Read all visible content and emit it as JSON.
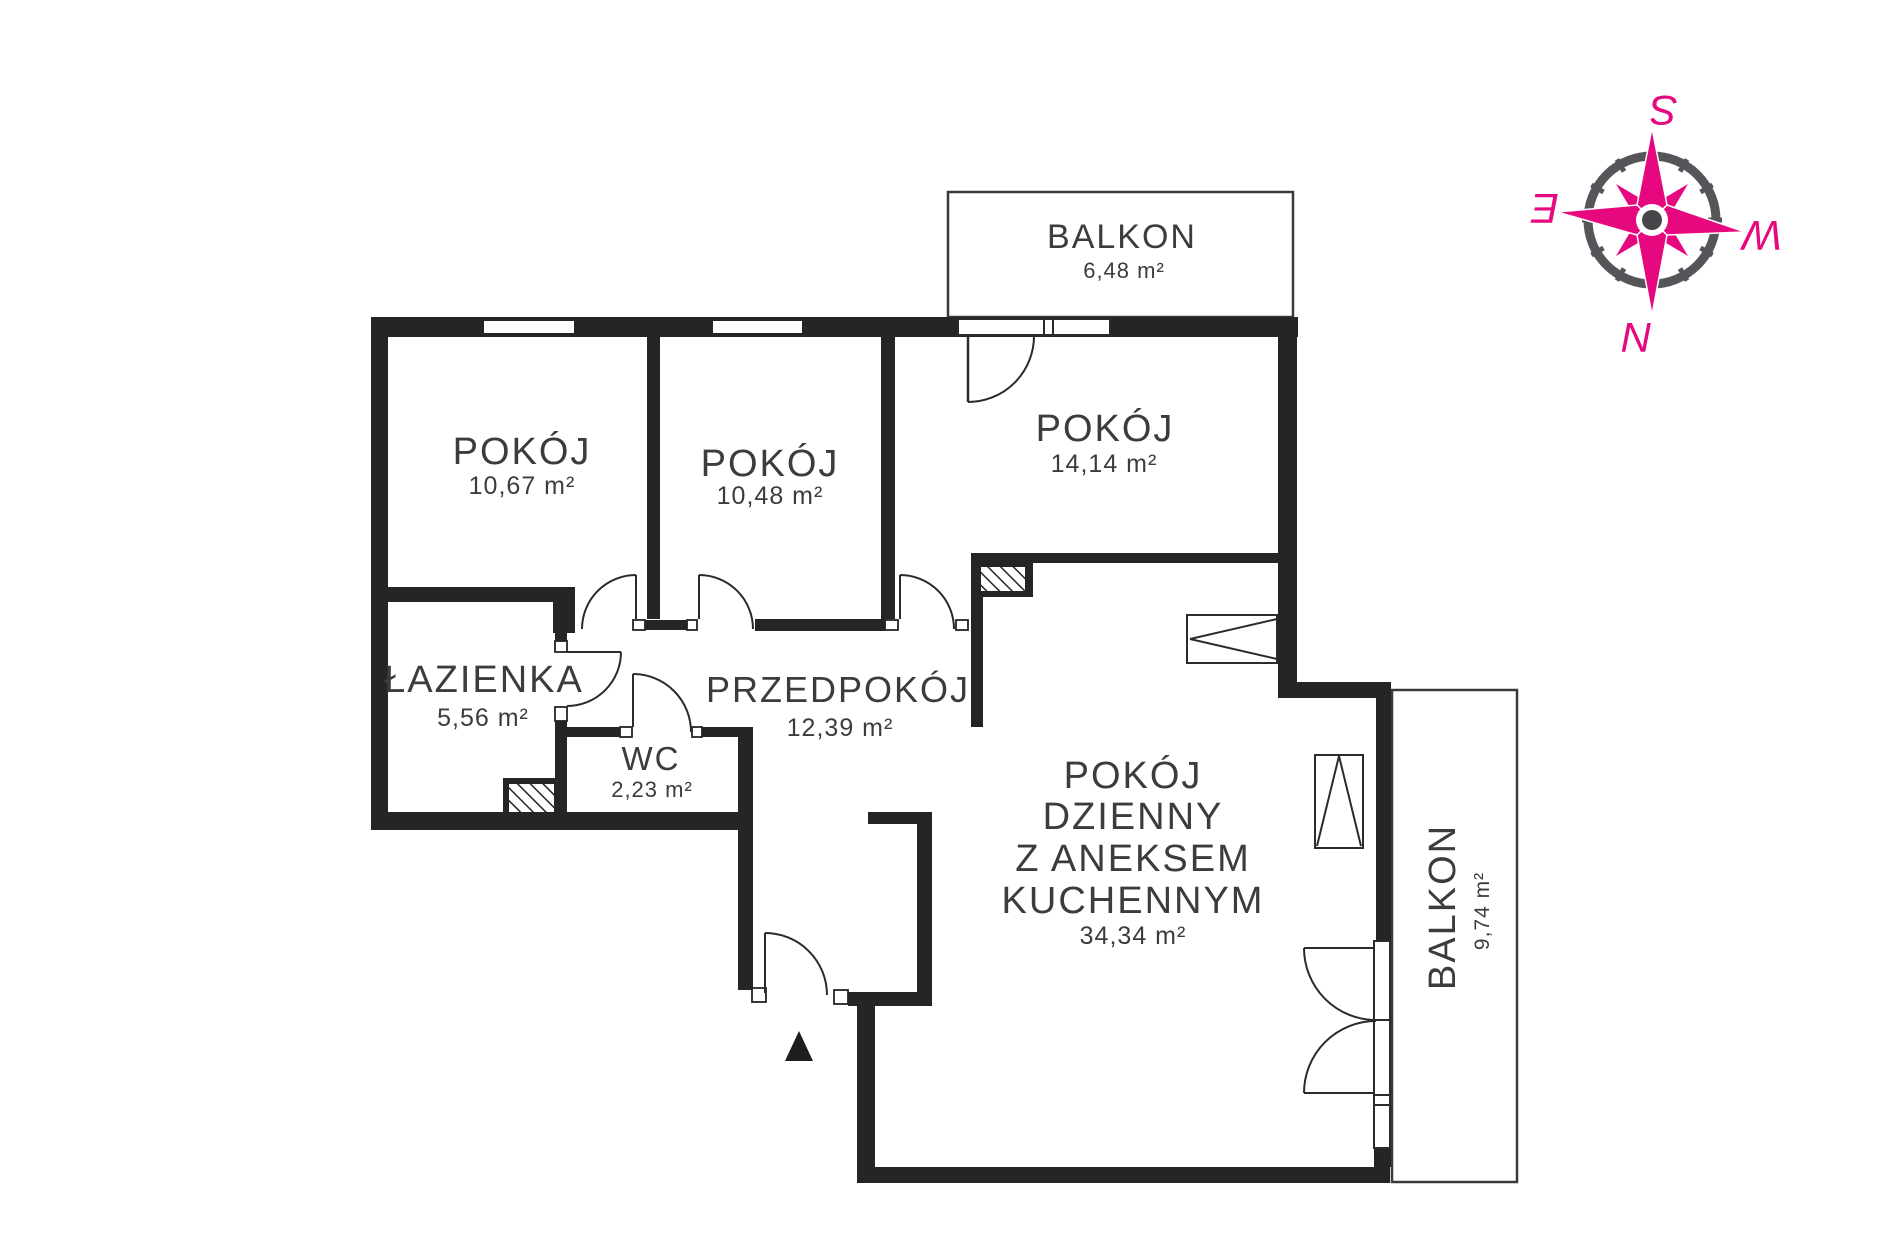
{
  "plan_title": "apartment-floor-plan",
  "rooms": [
    {
      "id": "pokoj-1",
      "name": "POKÓJ",
      "area": "10,67 m²"
    },
    {
      "id": "pokoj-2",
      "name": "POKÓJ",
      "area": "10,48 m²"
    },
    {
      "id": "pokoj-3",
      "name": "POKÓJ",
      "area": "14,14 m²"
    },
    {
      "id": "lazienka",
      "name": "ŁAZIENKA",
      "area": "5,56 m²"
    },
    {
      "id": "wc",
      "name": "WC",
      "area": "2,23 m²"
    },
    {
      "id": "przedpokoj",
      "name": "PRZEDPOKÓJ",
      "area": "12,39 m²"
    },
    {
      "id": "pokoj-dzienny",
      "name_lines": [
        "POKÓJ",
        "DZIENNY",
        "Z ANEKSEM",
        "KUCHENNYM"
      ],
      "area": "34,34 m²"
    },
    {
      "id": "balkon-top",
      "name": "BALKON",
      "area": "6,48 m²"
    },
    {
      "id": "balkon-right",
      "name": "BALKON",
      "area": "9,74 m²"
    }
  ],
  "compass": {
    "south": "S",
    "west": "W",
    "north": "N",
    "east": "E",
    "accent_color": "#E5087E",
    "ring_color": "#55555A"
  },
  "colors": {
    "wall": "#252525",
    "text": "#3C3C3C",
    "thin_line": "#2B2B2B"
  }
}
